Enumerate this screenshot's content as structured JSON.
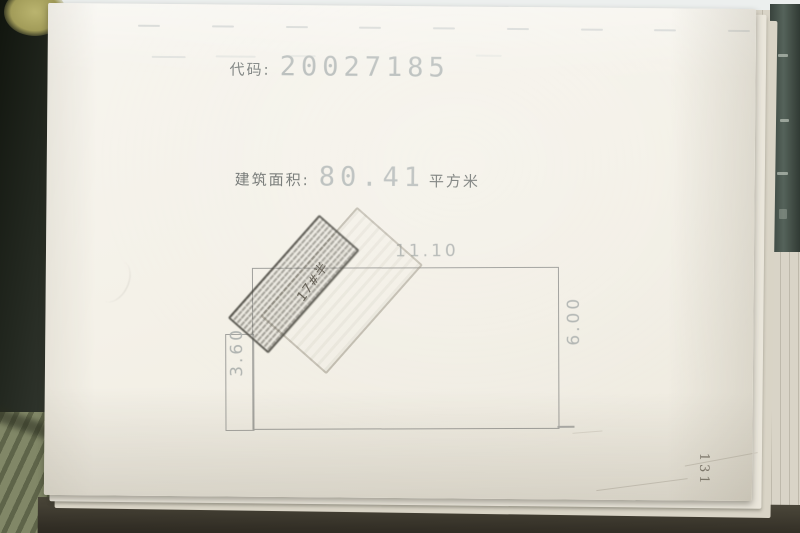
{
  "document": {
    "code_label": "代码:",
    "code_value": "20027185",
    "area_label": "建筑面积:",
    "area_value": "80.41",
    "area_unit": "平方米",
    "page_number": "131",
    "handwriting_note": "17#半"
  },
  "floor_plan": {
    "top_dimension": "11.10",
    "right_dimension": "6.00",
    "left_dimension": "3.60"
  },
  "colors": {
    "paper": "#f4f1e8",
    "ink_light_number": "#b7bcba",
    "ink_dark_label": "#6e726f",
    "plan_line": "#9b9b97",
    "stamp_dark": "#46443c",
    "stamp_light": "#98917f",
    "table_dark": "#232820",
    "carpet_green": "#79805e",
    "right_band": "#39433d",
    "corner_spot": "#bab46f"
  }
}
